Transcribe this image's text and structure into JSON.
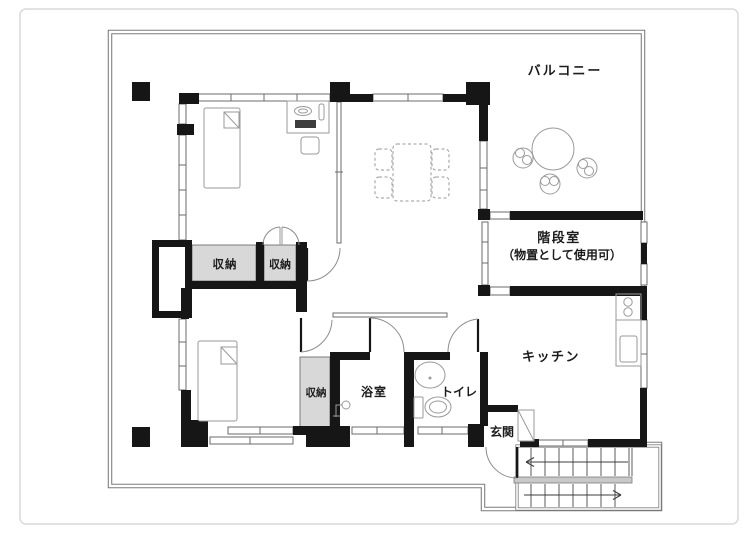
{
  "plan": {
    "rooms": {
      "balcony": {
        "label": "バルコニー"
      },
      "stair_room": {
        "label": "階段室",
        "note": "（物置として使用可）"
      },
      "kitchen": {
        "label": "キッチン"
      },
      "bath": {
        "label": "浴室"
      },
      "toilet": {
        "label": "トイレ"
      },
      "entrance": {
        "label": "玄関"
      },
      "closet_main_left": {
        "label": "収納"
      },
      "closet_main_right": {
        "label": "収納"
      },
      "closet_lower": {
        "label": "収納"
      }
    },
    "colors": {
      "wall": "#161616",
      "closet_fill": "#d8d8d8",
      "outline": "#7a7a7a",
      "fixture_line": "#9a9a9a",
      "text": "#1c1c1c",
      "page_border": "#d9d9d9"
    }
  }
}
